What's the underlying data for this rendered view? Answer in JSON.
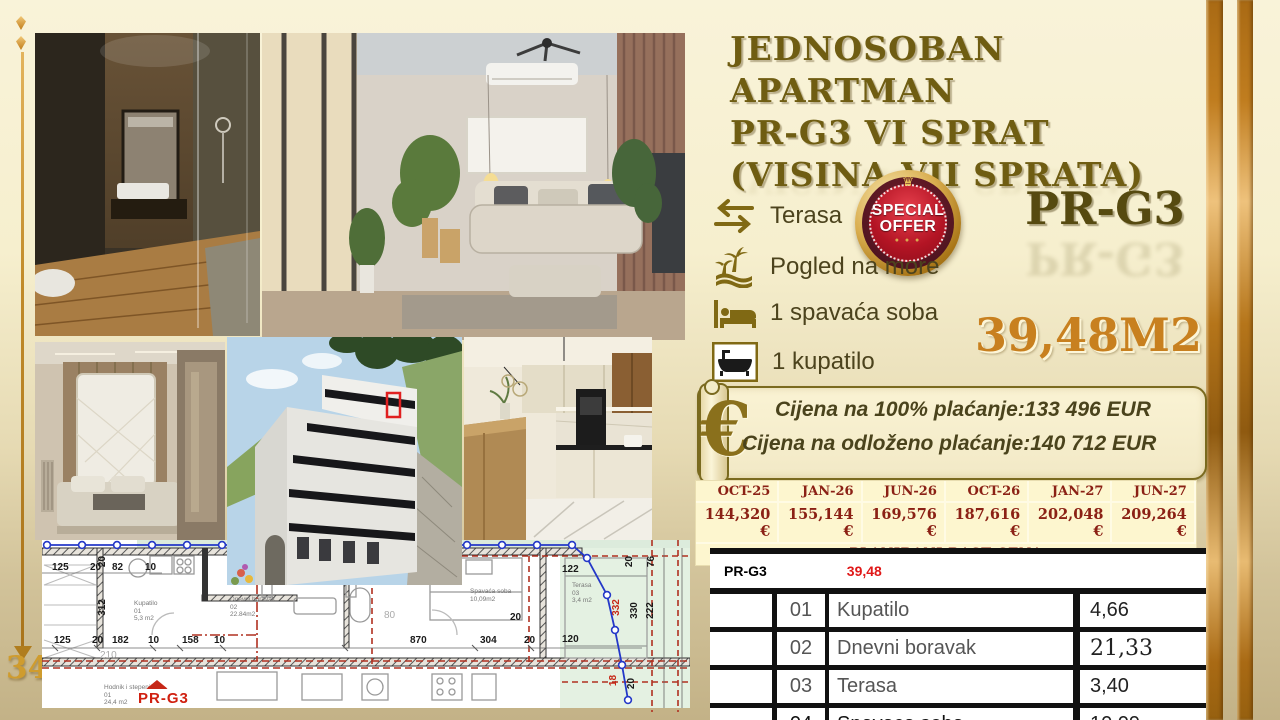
{
  "page": {
    "number": "34"
  },
  "title": {
    "line1": "JEDNOSOBAN  APARTMAN",
    "line2": "PR-G3    VI SPRAT",
    "line3": "(VISINA VII SPRATA)"
  },
  "badge": {
    "line1": "SPECIAL",
    "line2": "OFFER",
    "crown": "♛",
    "ornament": "● ● ●"
  },
  "unit": {
    "code": "PR-G3",
    "area": "39,48M2"
  },
  "amenities": [
    {
      "icon": "terrace-arrows-icon",
      "label": "Terasa"
    },
    {
      "icon": "sea-view-palms-icon",
      "label": "Pogled na more"
    },
    {
      "icon": "bed-icon",
      "label": "1 spavaća soba"
    },
    {
      "icon": "bathtub-icon",
      "label": "1 kupatilo"
    }
  ],
  "pricing": {
    "euro_symbol": "€",
    "line1": "Cijena na 100% plaćanje:133 496 EUR",
    "line2": "Cijena na odloženo plaćanje:140 712 EUR"
  },
  "price_table": {
    "columns": [
      "OCT-25",
      "JAN-26",
      "JUN-26",
      "OCT-26",
      "JAN-27",
      "JUN-27"
    ],
    "values": [
      "144,320 €",
      "155,144 €",
      "169,576 €",
      "187,616 €",
      "202,048 €",
      "209,264 €"
    ],
    "footer": "PLANIRANI RAST CENA"
  },
  "room_table": {
    "header": {
      "code": "PR-G3",
      "area": "39,48"
    },
    "rows": [
      {
        "num": "01",
        "name": "Kupatilo",
        "area": "4,66"
      },
      {
        "num": "02",
        "name": "Dnevni boravak",
        "area": "21,33"
      },
      {
        "num": "03",
        "name": "Terasa",
        "area": "3,40"
      },
      {
        "num": "04",
        "name": "Spavaca soba",
        "area": "10,09"
      }
    ]
  },
  "floor_plan": {
    "unit_label": "PR-G3",
    "rooms": [
      "Kupatilo\n01\n5,3 m2",
      "Dnevni boravak\n02\n22.84m2",
      "Spavaća soba\n10,09m2",
      "Terasa\n03\n3,4 m2",
      "Hodnik i stepenište\n01\n24,4 m2"
    ],
    "dims": [
      "125",
      "20",
      "82",
      "10",
      "312",
      "20",
      "125",
      "20",
      "182",
      "10",
      "158",
      "10",
      "870",
      "304",
      "20",
      "122",
      "20",
      "120",
      "332",
      "330",
      "222",
      "76",
      "20",
      "18",
      "20",
      "210",
      "80"
    ]
  },
  "photos": [
    {
      "name": "bathroom-photo"
    },
    {
      "name": "living-room-photo"
    },
    {
      "name": "bedroom-photo"
    },
    {
      "name": "building-exterior-photo"
    },
    {
      "name": "kitchen-photo"
    }
  ]
}
